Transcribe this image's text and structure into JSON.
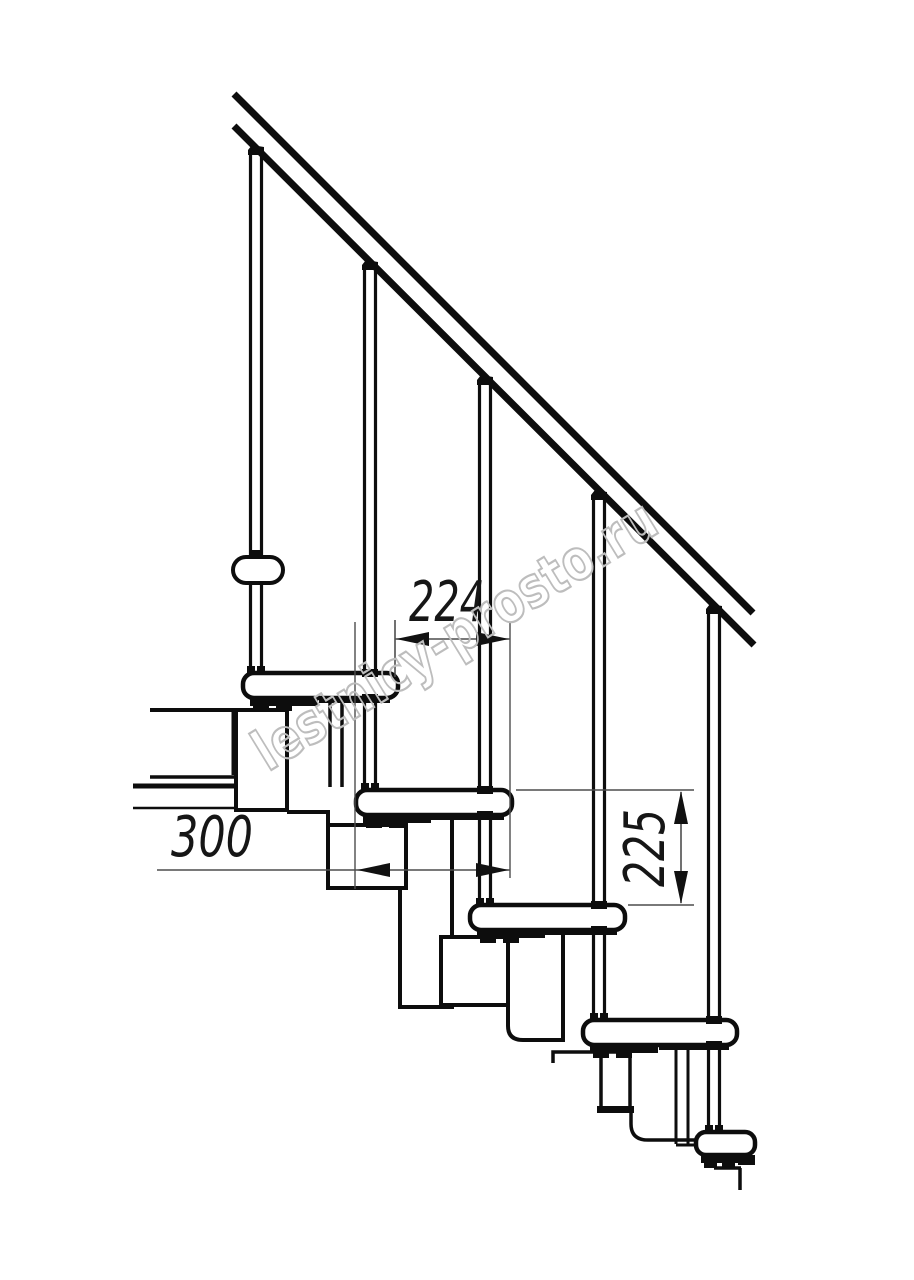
{
  "diagram": {
    "type": "staircase-side-view-technical-drawing",
    "watermark": "lestnicy-prosto.ru",
    "dimensions": [
      {
        "id": "dim-224",
        "value": "224",
        "orientation": "horizontal"
      },
      {
        "id": "dim-300",
        "value": "300",
        "orientation": "horizontal"
      },
      {
        "id": "dim-225",
        "value": "225",
        "orientation": "vertical"
      }
    ],
    "counts": {
      "treads": 5,
      "balusters": 5,
      "handrail_lines": 2
    },
    "colors": {
      "background": "#ffffff",
      "line": "#0d0d0d",
      "dimension_line": "#4d4d4d",
      "dimension_text": "#161616",
      "watermark_outline": "#bdbdbd"
    }
  }
}
